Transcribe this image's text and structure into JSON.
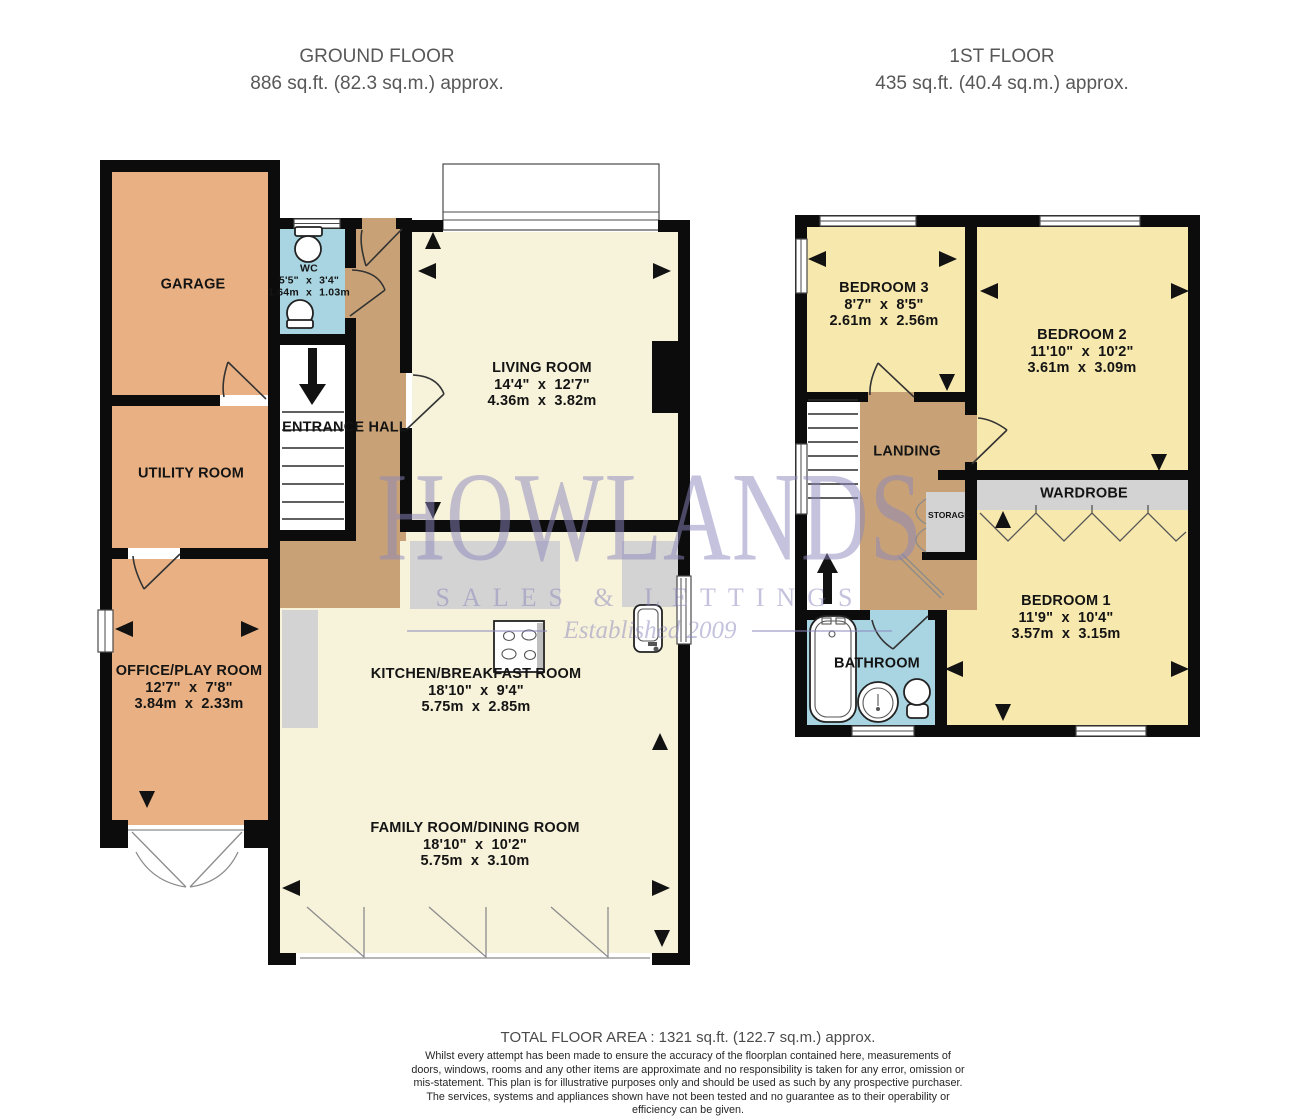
{
  "colors": {
    "tan": "#e9b183",
    "cream": "#f7f2da",
    "yellow": "#f7e8ad",
    "hall": "#c8a276",
    "blue": "#a9d5e2",
    "gray": "#d3d3d3",
    "wall": "#0c0c0c",
    "wm": "#8a87bd"
  },
  "ground_floor": {
    "title": "GROUND FLOOR",
    "area": "886 sq.ft. (82.3 sq.m.) approx.",
    "rooms": {
      "garage": {
        "name": "GARAGE"
      },
      "utility": {
        "name": "UTILITY ROOM"
      },
      "office": {
        "name": "OFFICE/PLAY ROOM",
        "dims_ft": "12'7\" x 7'8\"",
        "dims_m": "3.84m x 2.33m"
      },
      "wc": {
        "name": "WC",
        "dims_ft": "5'5\" x 3'4\"",
        "dims_m": "1.64m x 1.03m"
      },
      "entrance_hall": {
        "name": "ENTRANCE HALL"
      },
      "living": {
        "name": "LIVING ROOM",
        "dims_ft": "14'4\" x 12'7\"",
        "dims_m": "4.36m x 3.82m"
      },
      "kitchen": {
        "name": "KITCHEN/BREAKFAST ROOM",
        "dims_ft": "18'10\" x 9'4\"",
        "dims_m": "5.75m x 2.85m"
      },
      "family": {
        "name": "FAMILY ROOM/DINING ROOM",
        "dims_ft": "18'10\" x 10'2\"",
        "dims_m": "5.75m x 3.10m"
      }
    }
  },
  "first_floor": {
    "title": "1ST FLOOR",
    "area": "435 sq.ft. (40.4 sq.m.) approx.",
    "rooms": {
      "bedroom3": {
        "name": "BEDROOM 3",
        "dims_ft": "8'7\" x 8'5\"",
        "dims_m": "2.61m x 2.56m"
      },
      "bedroom2": {
        "name": "BEDROOM 2",
        "dims_ft": "11'10\" x 10'2\"",
        "dims_m": "3.61m x 3.09m"
      },
      "landing": {
        "name": "LANDING"
      },
      "wardrobe": {
        "name": "WARDROBE"
      },
      "storage": {
        "name": "STORAGE"
      },
      "bedroom1": {
        "name": "BEDROOM 1",
        "dims_ft": "11'9\" x 10'4\"",
        "dims_m": "3.57m x 3.15m"
      },
      "bathroom": {
        "name": "BATHROOM"
      }
    }
  },
  "watermark": {
    "name": "HOWLANDS",
    "tagline": "SALES & LETTINGS",
    "established": "Established 2009"
  },
  "footer": {
    "total_area": "TOTAL FLOOR AREA : 1321 sq.ft. (122.7 sq.m.) approx.",
    "disclaimer": "Whilst every attempt has been made to ensure the accuracy of the floorplan contained here, measurements of doors, windows, rooms and any other items are approximate and no responsibility is taken for any error, omission or mis-statement. This plan is for illustrative purposes only and should be used as such by any prospective purchaser. The services, systems and appliances shown have not been tested and no guarantee as to their operability or efficiency can be given.",
    "credit": "Made with Metropix ©2025"
  }
}
